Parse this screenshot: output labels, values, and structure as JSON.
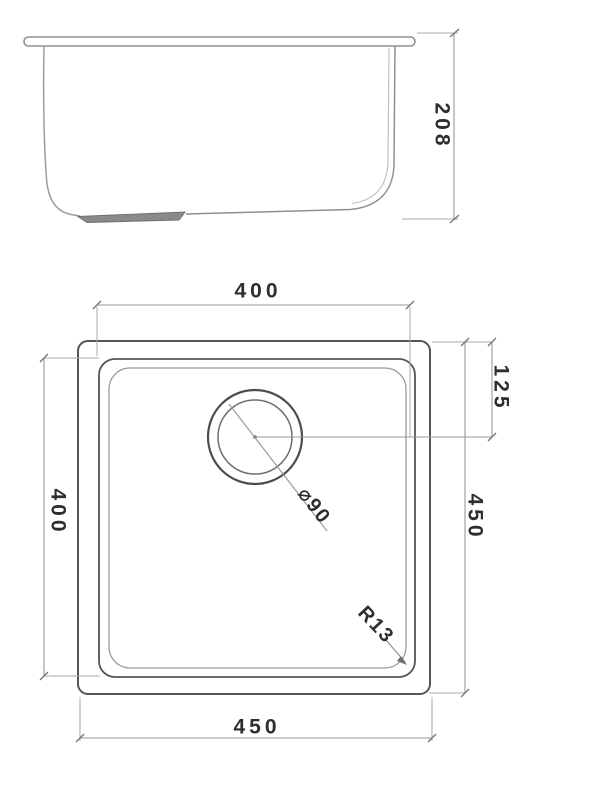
{
  "drawing": {
    "kind": "sink-technical-drawing",
    "views": {
      "elevation": "side-elevation-view",
      "plan": "plan-view"
    }
  },
  "dims": {
    "elevation_height": "208",
    "bowl_width_top": "400",
    "bowl_depth_left": "400",
    "outer_depth_right": "450",
    "outer_width_bottom": "450",
    "drain_offset": "125",
    "drain_diameter": "⌀90",
    "corner_radius": "R13"
  },
  "colors": {
    "line_strong": "#565656",
    "line_medium": "#8f8f8f",
    "line_light": "#aaaaaa",
    "dimension_line": "#999999",
    "text": "#2e2e2e",
    "drain_pad_fill": "#8a8a8a",
    "background": "#ffffff"
  }
}
